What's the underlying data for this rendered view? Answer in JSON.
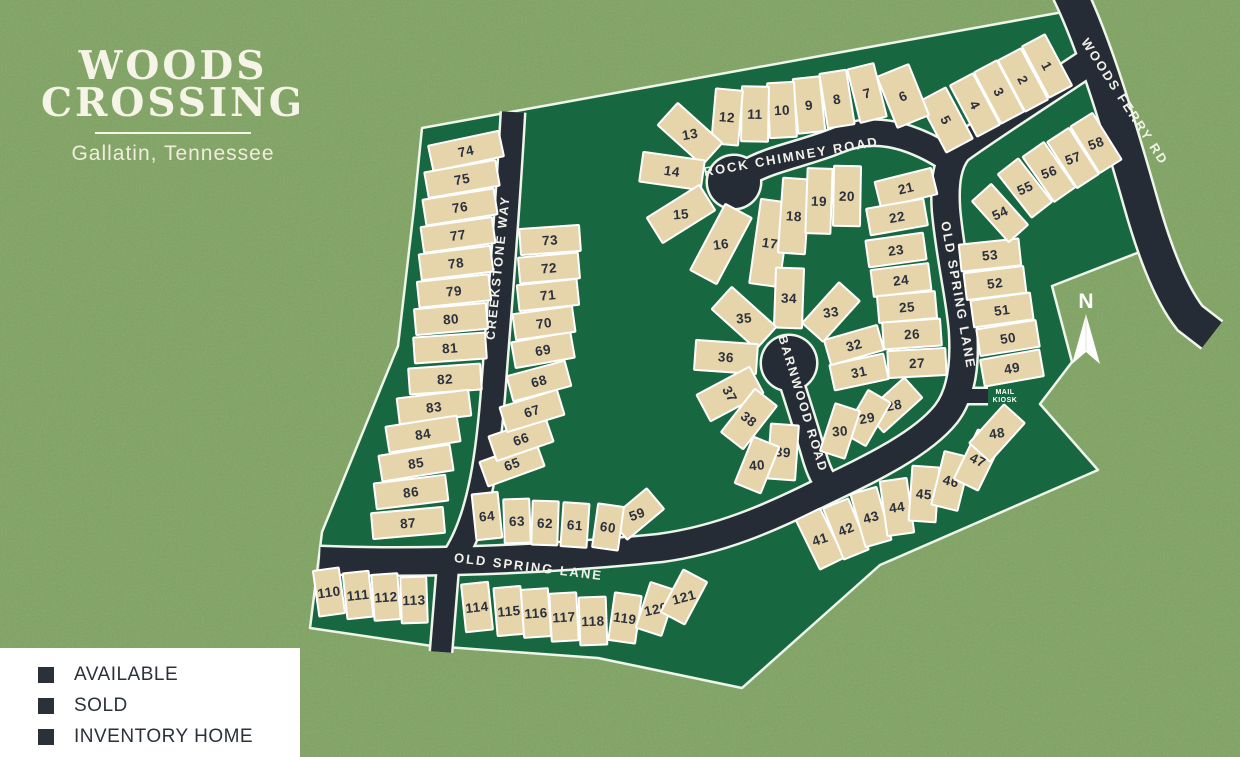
{
  "title": {
    "line1": "WOODS",
    "line2": "CROSSING",
    "subtitle": "Gallatin, Tennessee"
  },
  "legend": {
    "items": [
      {
        "label": "AVAILABLE",
        "color": "#2b3139"
      },
      {
        "label": "SOLD",
        "color": "#2b3139"
      },
      {
        "label": "INVENTORY HOME",
        "color": "#2b3139"
      }
    ]
  },
  "map": {
    "colors": {
      "background_green": "#7fa361",
      "common_area_green": "#176840",
      "road": "#262c35",
      "road_casing": "#eef5ea",
      "lot_fill": "#e6d4ab",
      "lot_line": "#ffffff",
      "lot_number_text": "#2b313c",
      "road_label_text": "#f2f1e9",
      "boundary_line": "#eef5ea"
    },
    "north_label": "N",
    "mail_kiosk_label": [
      "MAIL",
      "KIOSK"
    ],
    "road_labels": [
      {
        "id": "woods-ferry-rd-label",
        "text": "WOODS FERRY RD",
        "x": 1121,
        "y": 104,
        "r": 57,
        "size": 13
      },
      {
        "id": "rock-chimney-road-label",
        "text": "ROCK CHIMNEY ROAD",
        "x": 792,
        "y": 161,
        "r": -10,
        "size": 13
      },
      {
        "id": "old-spring-lane-label-south",
        "text": "OLD SPRING LANE",
        "x": 528,
        "y": 571,
        "r": 7,
        "size": 13
      },
      {
        "id": "old-spring-lane-label-east",
        "text": "OLD SPRING LANE",
        "x": 954,
        "y": 296,
        "r": 80,
        "size": 13
      },
      {
        "id": "barnwood-road-label",
        "text": "BARNWOOD ROAD",
        "x": 799,
        "y": 405,
        "r": 73,
        "size": 12.5
      },
      {
        "id": "creekstone-way-label",
        "text": "CREEKSTONE WAY",
        "x": 502,
        "y": 268,
        "r": -84,
        "size": 12.5
      }
    ],
    "lots_format": "[number, center_x, center_y, width, depth, rotation_deg, optional_number_text_rotation]",
    "lots": [
      [
        1,
        1047,
        66,
        26,
        58,
        -28
      ],
      [
        2,
        1023,
        80,
        26,
        58,
        -28
      ],
      [
        3,
        999,
        92,
        26,
        58,
        -28
      ],
      [
        4,
        975,
        105,
        26,
        58,
        -28
      ],
      [
        5,
        946,
        120,
        30,
        58,
        -28
      ],
      [
        6,
        903,
        96,
        34,
        55,
        -22
      ],
      [
        7,
        867,
        93,
        27,
        55,
        -14
      ],
      [
        8,
        837,
        99,
        27,
        55,
        -9
      ],
      [
        9,
        809,
        105,
        27,
        55,
        -6
      ],
      [
        10,
        782,
        110,
        27,
        55,
        -3
      ],
      [
        11,
        755,
        114,
        27,
        55,
        1
      ],
      [
        12,
        727,
        117,
        27,
        55,
        5
      ],
      [
        13,
        690,
        134,
        60,
        30,
        42,
        -10
      ],
      [
        14,
        672,
        171,
        62,
        30,
        8
      ],
      [
        15,
        681,
        214,
        62,
        30,
        -32,
        -5
      ],
      [
        16,
        721,
        244,
        75,
        30,
        -62,
        -8
      ],
      [
        17,
        770,
        243,
        85,
        30,
        -82
      ],
      [
        18,
        794,
        216,
        75,
        27,
        -86
      ],
      [
        19,
        819,
        201,
        65,
        25,
        -88
      ],
      [
        20,
        847,
        196,
        60,
        27,
        -89
      ],
      [
        21,
        906,
        188,
        58,
        27,
        -14
      ],
      [
        22,
        897,
        217,
        58,
        27,
        -10
      ],
      [
        23,
        896,
        250,
        58,
        27,
        -8
      ],
      [
        24,
        901,
        280,
        58,
        27,
        -7
      ],
      [
        25,
        907,
        307,
        58,
        27,
        -5
      ],
      [
        26,
        912,
        334,
        58,
        27,
        -4
      ],
      [
        27,
        917,
        363,
        58,
        27,
        -3
      ],
      [
        28,
        894,
        405,
        52,
        27,
        -42,
        -10
      ],
      [
        29,
        867,
        418,
        50,
        26,
        -60,
        -10
      ],
      [
        30,
        840,
        431,
        50,
        26,
        -72,
        -5
      ],
      [
        31,
        859,
        372,
        55,
        26,
        -12
      ],
      [
        32,
        854,
        345,
        55,
        26,
        -16
      ],
      [
        33,
        831,
        312,
        55,
        28,
        -48,
        -8
      ],
      [
        34,
        789,
        298,
        60,
        28,
        -88
      ],
      [
        35,
        744,
        318,
        60,
        30,
        42,
        -5
      ],
      [
        36,
        726,
        357,
        62,
        30,
        4
      ],
      [
        37,
        730,
        394,
        60,
        30,
        -28
      ],
      [
        38,
        749,
        419,
        55,
        28,
        -52
      ],
      [
        39,
        783,
        452,
        55,
        28,
        -86
      ],
      [
        40,
        757,
        465,
        50,
        28,
        -68,
        -5
      ],
      [
        41,
        820,
        539,
        55,
        27,
        64,
        -18
      ],
      [
        42,
        846,
        529,
        55,
        27,
        68
      ],
      [
        43,
        871,
        517,
        55,
        27,
        74
      ],
      [
        44,
        897,
        507,
        55,
        27,
        82
      ],
      [
        45,
        924,
        494,
        55,
        27,
        -86
      ],
      [
        46,
        951,
        481,
        55,
        27,
        -76
      ],
      [
        47,
        978,
        460,
        55,
        27,
        -64
      ],
      [
        48,
        997,
        433,
        52,
        28,
        -48,
        -8
      ],
      [
        49,
        1012,
        368,
        60,
        27,
        -10
      ],
      [
        50,
        1008,
        338,
        60,
        27,
        -9
      ],
      [
        51,
        1002,
        310,
        60,
        27,
        -8
      ],
      [
        52,
        995,
        283,
        60,
        27,
        -7
      ],
      [
        53,
        990,
        255,
        60,
        27,
        -6
      ],
      [
        54,
        1000,
        213,
        55,
        26,
        48,
        -25
      ],
      [
        55,
        1025,
        188,
        55,
        26,
        52,
        -25
      ],
      [
        56,
        1049,
        172,
        55,
        26,
        55,
        -20
      ],
      [
        57,
        1073,
        158,
        55,
        26,
        57,
        -20
      ],
      [
        58,
        1096,
        143,
        55,
        26,
        58,
        -20
      ],
      [
        59,
        637,
        514,
        48,
        27,
        -40,
        -20
      ],
      [
        60,
        608,
        527,
        44,
        26,
        -82
      ],
      [
        61,
        575,
        525,
        44,
        26,
        -86
      ],
      [
        62,
        545,
        523,
        44,
        26,
        -88
      ],
      [
        63,
        517,
        521,
        44,
        26,
        88
      ],
      [
        64,
        487,
        516,
        46,
        26,
        84
      ],
      [
        65,
        512,
        464,
        60,
        26,
        -20
      ],
      [
        66,
        521,
        439,
        60,
        26,
        -19
      ],
      [
        67,
        532,
        411,
        60,
        26,
        -17
      ],
      [
        68,
        539,
        381,
        60,
        26,
        -15
      ],
      [
        69,
        543,
        350,
        60,
        26,
        -10
      ],
      [
        70,
        544,
        323,
        60,
        26,
        -8
      ],
      [
        71,
        548,
        295,
        60,
        26,
        -6
      ],
      [
        72,
        549,
        268,
        60,
        26,
        -5
      ],
      [
        73,
        550,
        240,
        60,
        26,
        -4
      ],
      [
        74,
        466,
        151,
        72,
        26,
        -12
      ],
      [
        75,
        462,
        179,
        72,
        26,
        -10
      ],
      [
        76,
        460,
        207,
        72,
        26,
        -9
      ],
      [
        77,
        458,
        235,
        72,
        26,
        -8
      ],
      [
        78,
        456,
        263,
        72,
        26,
        -7
      ],
      [
        79,
        454,
        291,
        72,
        26,
        -6
      ],
      [
        80,
        451,
        319,
        72,
        26,
        -5
      ],
      [
        81,
        450,
        348,
        72,
        26,
        -4
      ],
      [
        82,
        445,
        379,
        72,
        26,
        -4
      ],
      [
        83,
        434,
        407,
        72,
        26,
        -7
      ],
      [
        84,
        423,
        434,
        72,
        26,
        -9
      ],
      [
        85,
        416,
        463,
        72,
        26,
        -9
      ],
      [
        86,
        411,
        492,
        72,
        26,
        -7
      ],
      [
        87,
        408,
        523,
        72,
        26,
        -5
      ],
      [
        110,
        329,
        592,
        46,
        26,
        82
      ],
      [
        111,
        358,
        595,
        46,
        26,
        84
      ],
      [
        112,
        386,
        597,
        46,
        26,
        86
      ],
      [
        113,
        414,
        600,
        46,
        26,
        88
      ],
      [
        114,
        477,
        607,
        48,
        27,
        84
      ],
      [
        115,
        509,
        611,
        48,
        27,
        85
      ],
      [
        116,
        536,
        613,
        48,
        27,
        86
      ],
      [
        117,
        564,
        617,
        48,
        27,
        87
      ],
      [
        118,
        593,
        621,
        48,
        27,
        88
      ],
      [
        119,
        625,
        618,
        48,
        27,
        -82
      ],
      [
        120,
        656,
        609,
        48,
        27,
        -72,
        -12
      ],
      [
        121,
        684,
        597,
        48,
        27,
        -62,
        -15
      ]
    ]
  }
}
